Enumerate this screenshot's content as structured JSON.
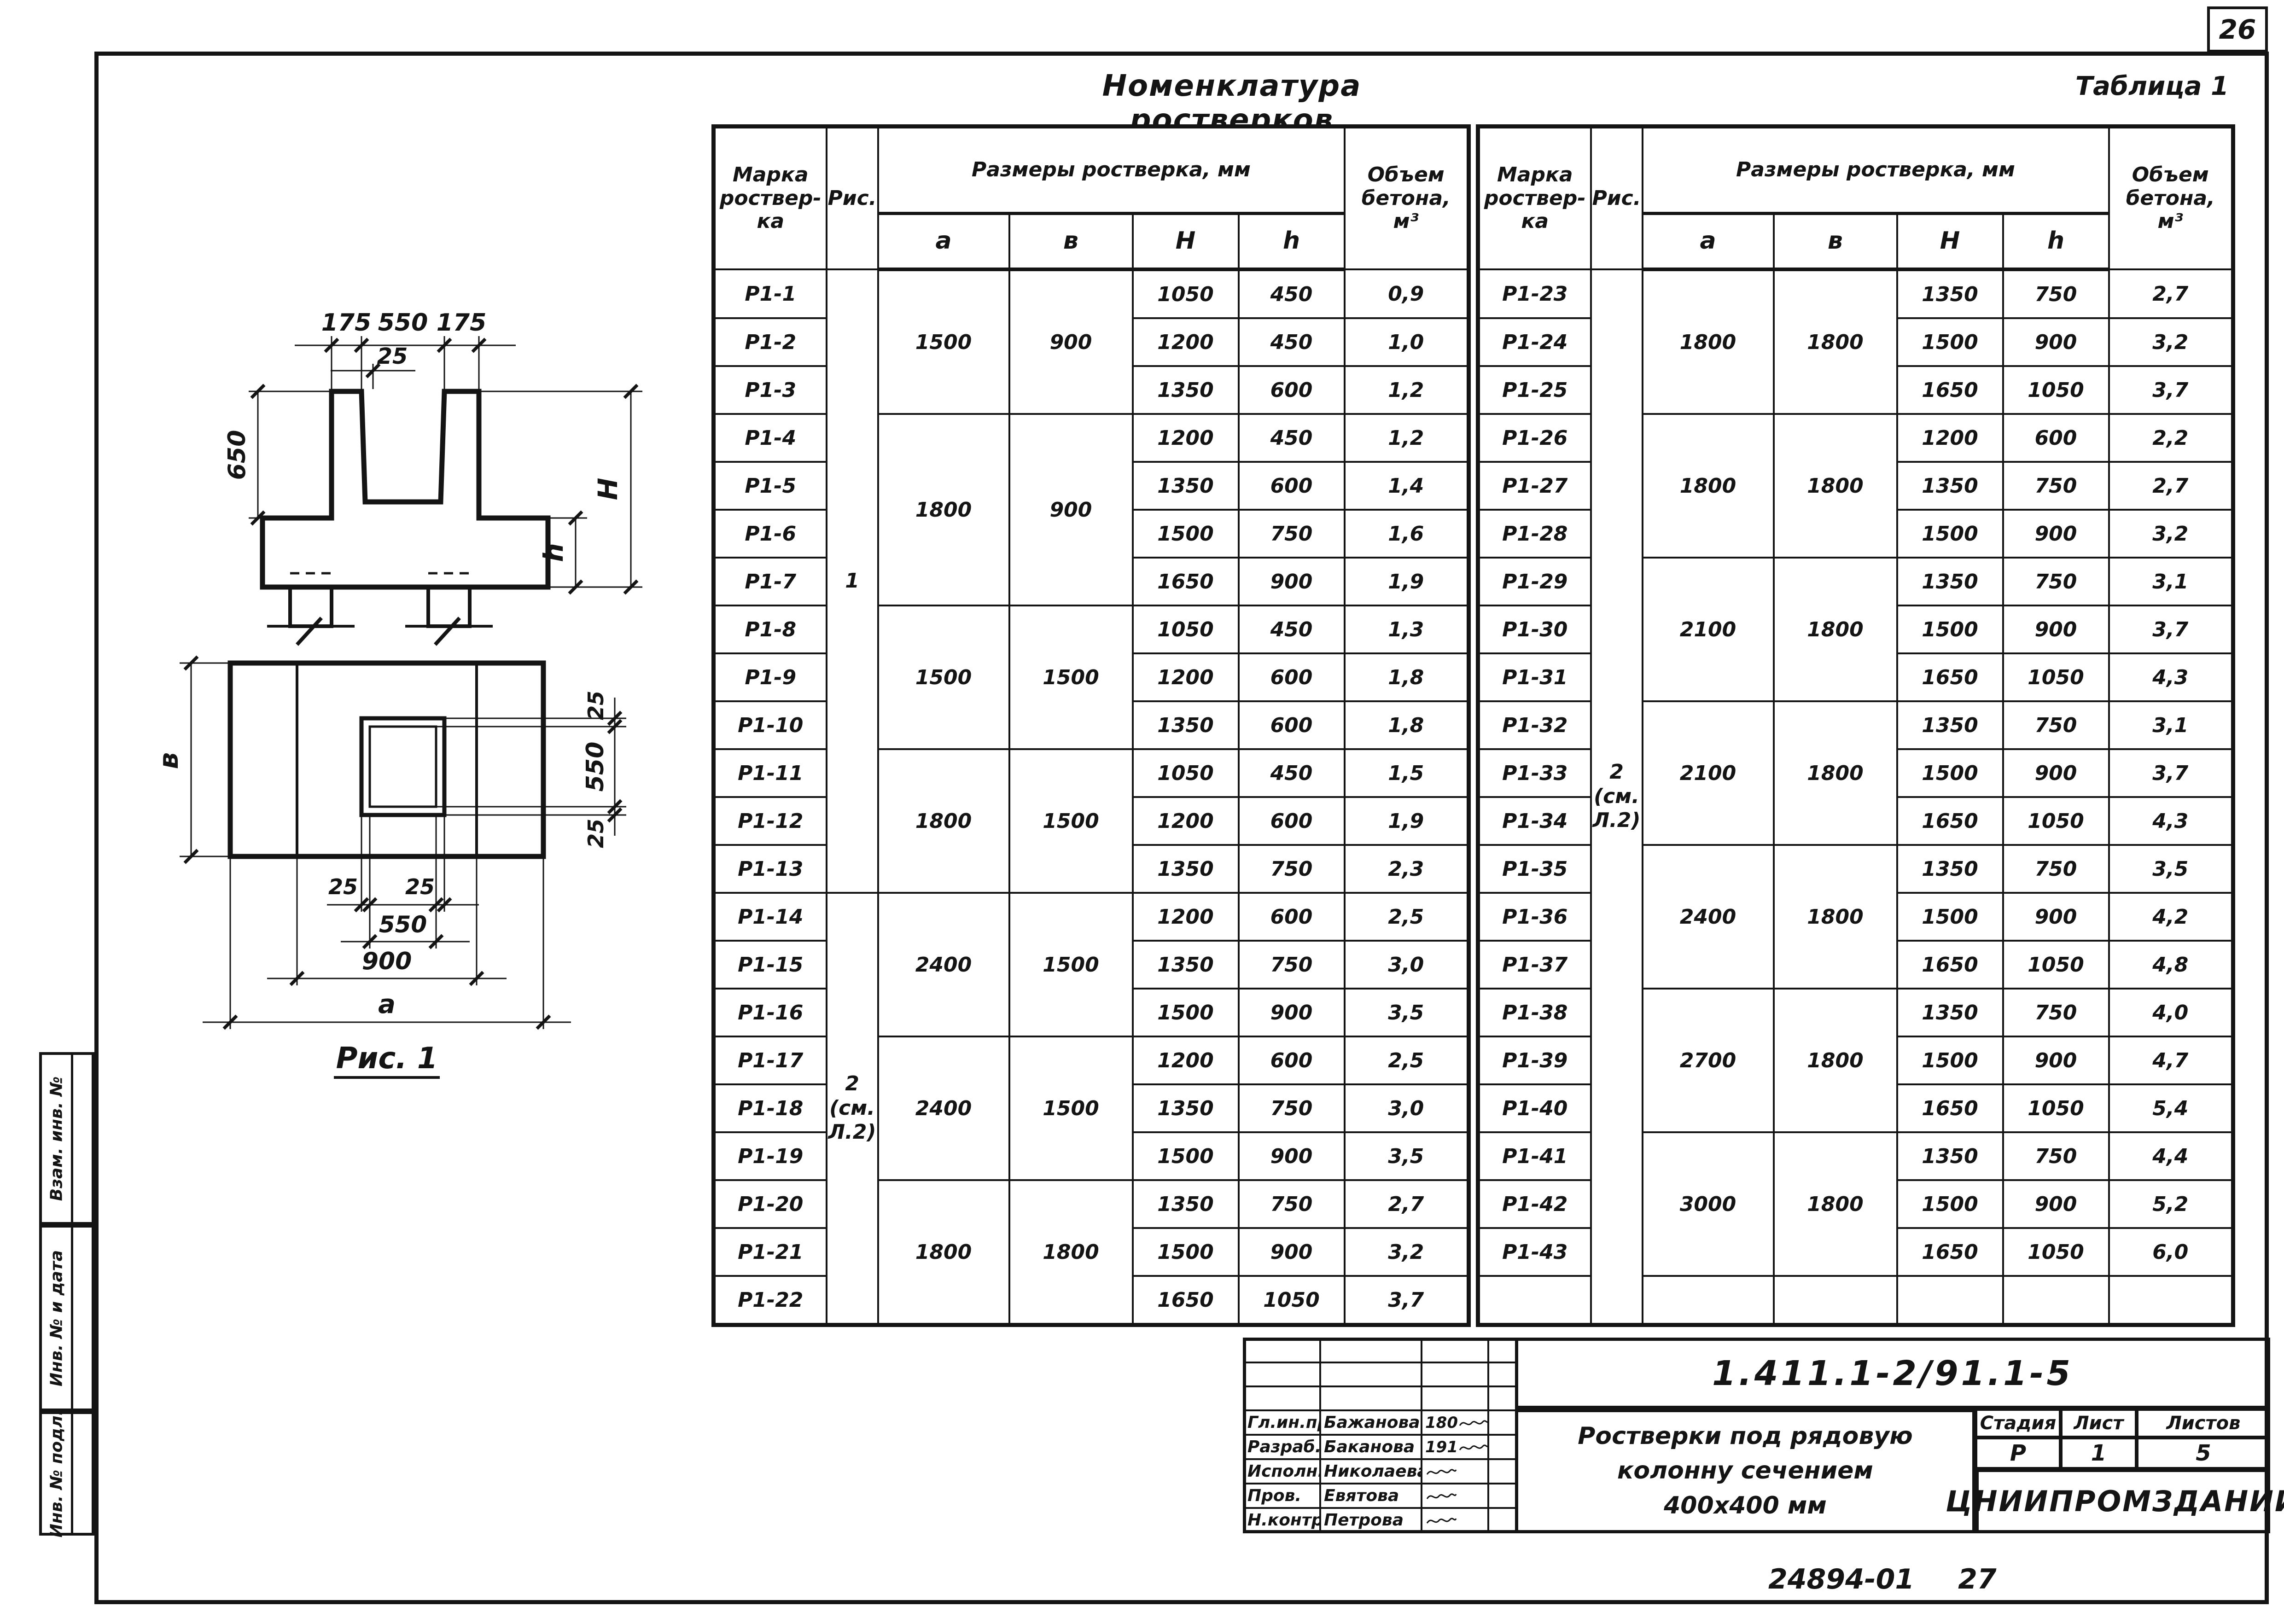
{
  "page": {
    "corner_number": "26",
    "footer_code": "24894-01",
    "footer_page": "27"
  },
  "margin_stamp": {
    "labels": [
      "Взам. инв. №",
      "Инв. № и дата",
      "Инв. № подл."
    ]
  },
  "table": {
    "title": "Номенклатура ростверков",
    "caption": "Таблица 1",
    "header": {
      "mark": "Марка\nроствер-\nка",
      "fig": "Рис.",
      "dims": "Размеры ростверка, мм",
      "a": "а",
      "b": "в",
      "H": "Н",
      "h": "h",
      "volume": "Объем\nбетона,\nм³"
    },
    "left_rows": [
      {
        "mark": "Р1-1",
        "H": "1050",
        "h": "450",
        "v": "0,9",
        "fig": {
          "text": "1",
          "rows": 13,
          "align": "upper"
        },
        "ab": {
          "a": "1500",
          "b": "900",
          "rows": 3
        }
      },
      {
        "mark": "Р1-2",
        "H": "1200",
        "h": "450",
        "v": "1,0"
      },
      {
        "mark": "Р1-3",
        "H": "1350",
        "h": "600",
        "v": "1,2"
      },
      {
        "mark": "Р1-4",
        "H": "1200",
        "h": "450",
        "v": "1,2",
        "ab": {
          "a": "1800",
          "b": "900",
          "rows": 4
        }
      },
      {
        "mark": "Р1-5",
        "H": "1350",
        "h": "600",
        "v": "1,4"
      },
      {
        "mark": "Р1-6",
        "H": "1500",
        "h": "750",
        "v": "1,6"
      },
      {
        "mark": "Р1-7",
        "H": "1650",
        "h": "900",
        "v": "1,9"
      },
      {
        "mark": "Р1-8",
        "H": "1050",
        "h": "450",
        "v": "1,3",
        "ab": {
          "a": "1500",
          "b": "1500",
          "rows": 3
        }
      },
      {
        "mark": "Р1-9",
        "H": "1200",
        "h": "600",
        "v": "1,8"
      },
      {
        "mark": "Р1-10",
        "H": "1350",
        "h": "600",
        "v": "1,8"
      },
      {
        "mark": "Р1-11",
        "H": "1050",
        "h": "450",
        "v": "1,5",
        "ab": {
          "a": "1800",
          "b": "1500",
          "rows": 3
        }
      },
      {
        "mark": "Р1-12",
        "H": "1200",
        "h": "600",
        "v": "1,9"
      },
      {
        "mark": "Р1-13",
        "H": "1350",
        "h": "750",
        "v": "2,3"
      },
      {
        "mark": "Р1-14",
        "H": "1200",
        "h": "600",
        "v": "2,5",
        "fig": {
          "text": "2\n(см.\nЛ.2)",
          "rows": 9,
          "align": "top"
        },
        "ab": {
          "a": "2400",
          "b": "1500",
          "rows": 3
        }
      },
      {
        "mark": "Р1-15",
        "H": "1350",
        "h": "750",
        "v": "3,0"
      },
      {
        "mark": "Р1-16",
        "H": "1500",
        "h": "900",
        "v": "3,5"
      },
      {
        "mark": "Р1-17",
        "H": "1200",
        "h": "600",
        "v": "2,5",
        "ab": {
          "a": "2400",
          "b": "1500",
          "rows": 3
        }
      },
      {
        "mark": "Р1-18",
        "H": "1350",
        "h": "750",
        "v": "3,0"
      },
      {
        "mark": "Р1-19",
        "H": "1500",
        "h": "900",
        "v": "3,5"
      },
      {
        "mark": "Р1-20",
        "H": "1350",
        "h": "750",
        "v": "2,7",
        "ab": {
          "a": "1800",
          "b": "1800",
          "rows": 3
        }
      },
      {
        "mark": "Р1-21",
        "H": "1500",
        "h": "900",
        "v": "3,2"
      },
      {
        "mark": "Р1-22",
        "H": "1650",
        "h": "1050",
        "v": "3,7"
      }
    ],
    "right_rows": [
      {
        "mark": "Р1-23",
        "H": "1350",
        "h": "750",
        "v": "2,7",
        "fig": {
          "text": "2\n(см.\nЛ.2)",
          "rows": 22,
          "align": "middle"
        },
        "ab": {
          "a": "1800",
          "b": "1800",
          "rows": 3
        }
      },
      {
        "mark": "Р1-24",
        "H": "1500",
        "h": "900",
        "v": "3,2"
      },
      {
        "mark": "Р1-25",
        "H": "1650",
        "h": "1050",
        "v": "3,7"
      },
      {
        "mark": "Р1-26",
        "H": "1200",
        "h": "600",
        "v": "2,2",
        "ab": {
          "a": "1800",
          "b": "1800",
          "rows": 3
        }
      },
      {
        "mark": "Р1-27",
        "H": "1350",
        "h": "750",
        "v": "2,7"
      },
      {
        "mark": "Р1-28",
        "H": "1500",
        "h": "900",
        "v": "3,2"
      },
      {
        "mark": "Р1-29",
        "H": "1350",
        "h": "750",
        "v": "3,1",
        "ab": {
          "a": "2100",
          "b": "1800",
          "rows": 3
        }
      },
      {
        "mark": "Р1-30",
        "H": "1500",
        "h": "900",
        "v": "3,7"
      },
      {
        "mark": "Р1-31",
        "H": "1650",
        "h": "1050",
        "v": "4,3"
      },
      {
        "mark": "Р1-32",
        "H": "1350",
        "h": "750",
        "v": "3,1",
        "ab": {
          "a": "2100",
          "b": "1800",
          "rows": 3
        }
      },
      {
        "mark": "Р1-33",
        "H": "1500",
        "h": "900",
        "v": "3,7"
      },
      {
        "mark": "Р1-34",
        "H": "1650",
        "h": "1050",
        "v": "4,3"
      },
      {
        "mark": "Р1-35",
        "H": "1350",
        "h": "750",
        "v": "3,5",
        "ab": {
          "a": "2400",
          "b": "1800",
          "rows": 3
        }
      },
      {
        "mark": "Р1-36",
        "H": "1500",
        "h": "900",
        "v": "4,2"
      },
      {
        "mark": "Р1-37",
        "H": "1650",
        "h": "1050",
        "v": "4,8"
      },
      {
        "mark": "Р1-38",
        "H": "1350",
        "h": "750",
        "v": "4,0",
        "ab": {
          "a": "2700",
          "b": "1800",
          "rows": 3
        }
      },
      {
        "mark": "Р1-39",
        "H": "1500",
        "h": "900",
        "v": "4,7"
      },
      {
        "mark": "Р1-40",
        "H": "1650",
        "h": "1050",
        "v": "5,4"
      },
      {
        "mark": "Р1-41",
        "H": "1350",
        "h": "750",
        "v": "4,4",
        "ab": {
          "a": "3000",
          "b": "1800",
          "rows": 3
        }
      },
      {
        "mark": "Р1-42",
        "H": "1500",
        "h": "900",
        "v": "5,2"
      },
      {
        "mark": "Р1-43",
        "H": "1650",
        "h": "1050",
        "v": "6,0"
      },
      {
        "mark": "",
        "H": "",
        "h": "",
        "v": "",
        "ab": {
          "a": "",
          "b": "",
          "rows": 1
        }
      }
    ]
  },
  "figure": {
    "caption": "Рис. 1",
    "section": {
      "dim_175_left": "175",
      "dim_550_top": "550",
      "dim_175_right": "175",
      "dim_25": "25",
      "dim_650": "650",
      "dim_h": "h",
      "dim_H": "Н"
    },
    "plan": {
      "dim_b": "в",
      "dim_25_right_top": "25",
      "dim_550_right": "550",
      "dim_25_right_bottom": "25",
      "dim_25_bot_left": "25",
      "dim_25_bot_right": "25",
      "dim_550_bottom": "550",
      "dim_900": "900",
      "dim_a": "а"
    }
  },
  "title_block": {
    "doc_number": "1.411.1-2/91.1-5",
    "title_lines": [
      "Ростверки под рядовую",
      "колонну сечением",
      "400x400 мм"
    ],
    "stage_label": "Стадия",
    "sheet_label": "Лист",
    "sheets_label": "Листов",
    "stage": "Р",
    "sheet": "1",
    "sheets": "5",
    "organization": "ЦНИИПРОМЗДАНИЙ",
    "signatures": [
      {
        "role": "Гл.ин.пр.",
        "name": "Бажанова",
        "sig": "180"
      },
      {
        "role": "Разраб.",
        "name": "Баканова",
        "sig": "191"
      },
      {
        "role": "Исполн.",
        "name": "Николаева",
        "sig": ""
      },
      {
        "role": "Пров.",
        "name": "Евятова",
        "sig": ""
      },
      {
        "role": "Н.контр.",
        "name": "Петрова",
        "sig": ""
      }
    ]
  }
}
